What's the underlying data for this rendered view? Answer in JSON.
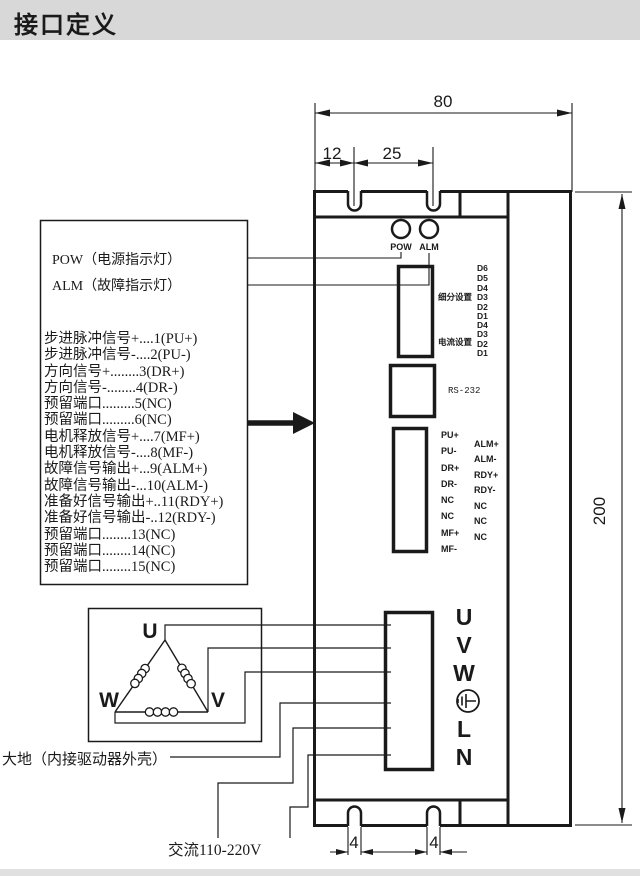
{
  "title": "接口定义",
  "colors": {
    "ink": "#1a1a1a",
    "title_bg": "#d8d8d8"
  },
  "dims": {
    "top_width": "80",
    "notch_offset": "12",
    "notch_pitch": "25",
    "height": "200",
    "slot_a": "4",
    "slot_b": "4"
  },
  "indicators": {
    "pow": "POW",
    "alm": "ALM"
  },
  "legend": {
    "pow_line": "POW（电源指示灯）",
    "alm_line": "ALM（故障指示灯）",
    "signals": [
      "步进脉冲信号+....1(PU+)",
      "步进脉冲信号-....2(PU-)",
      "方向信号+........3(DR+)",
      "方向信号-........4(DR-)",
      "预留端口.........5(NC)",
      "预留端口.........6(NC)",
      "电机释放信号+....7(MF+)",
      "电机释放信号-....8(MF-)",
      "故障信号输出+...9(ALM+)",
      "故障信号输出-...10(ALM-)",
      "准备好信号输出+..11(RDY+)",
      "准备好信号输出-..12(RDY-)",
      "预留端口........13(NC)",
      "预留端口........14(NC)",
      "预留端口........15(NC)"
    ]
  },
  "dip": {
    "group1_label": "细分设置",
    "group1_bits": [
      "D6",
      "D5",
      "D4",
      "D3",
      "D2",
      "D1"
    ],
    "group2_label": "电流设置",
    "group2_bits": [
      "D4",
      "D3",
      "D2",
      "D1"
    ]
  },
  "rs232": "RS-232",
  "signal_connector": {
    "col1": [
      "PU+",
      "PU-",
      "DR+",
      "DR-",
      "NC",
      "NC",
      "MF+",
      "MF-"
    ],
    "col2": [
      "ALM+",
      "ALM-",
      "RDY+",
      "RDY-",
      "NC",
      "NC",
      "NC"
    ]
  },
  "power": {
    "labels": [
      "U",
      "V",
      "W",
      "L",
      "N"
    ]
  },
  "motor": {
    "u": "U",
    "w": "W",
    "v": "V"
  },
  "notes": {
    "earth": "大地（内接驱动器外壳）",
    "ac": "交流110-220V"
  }
}
